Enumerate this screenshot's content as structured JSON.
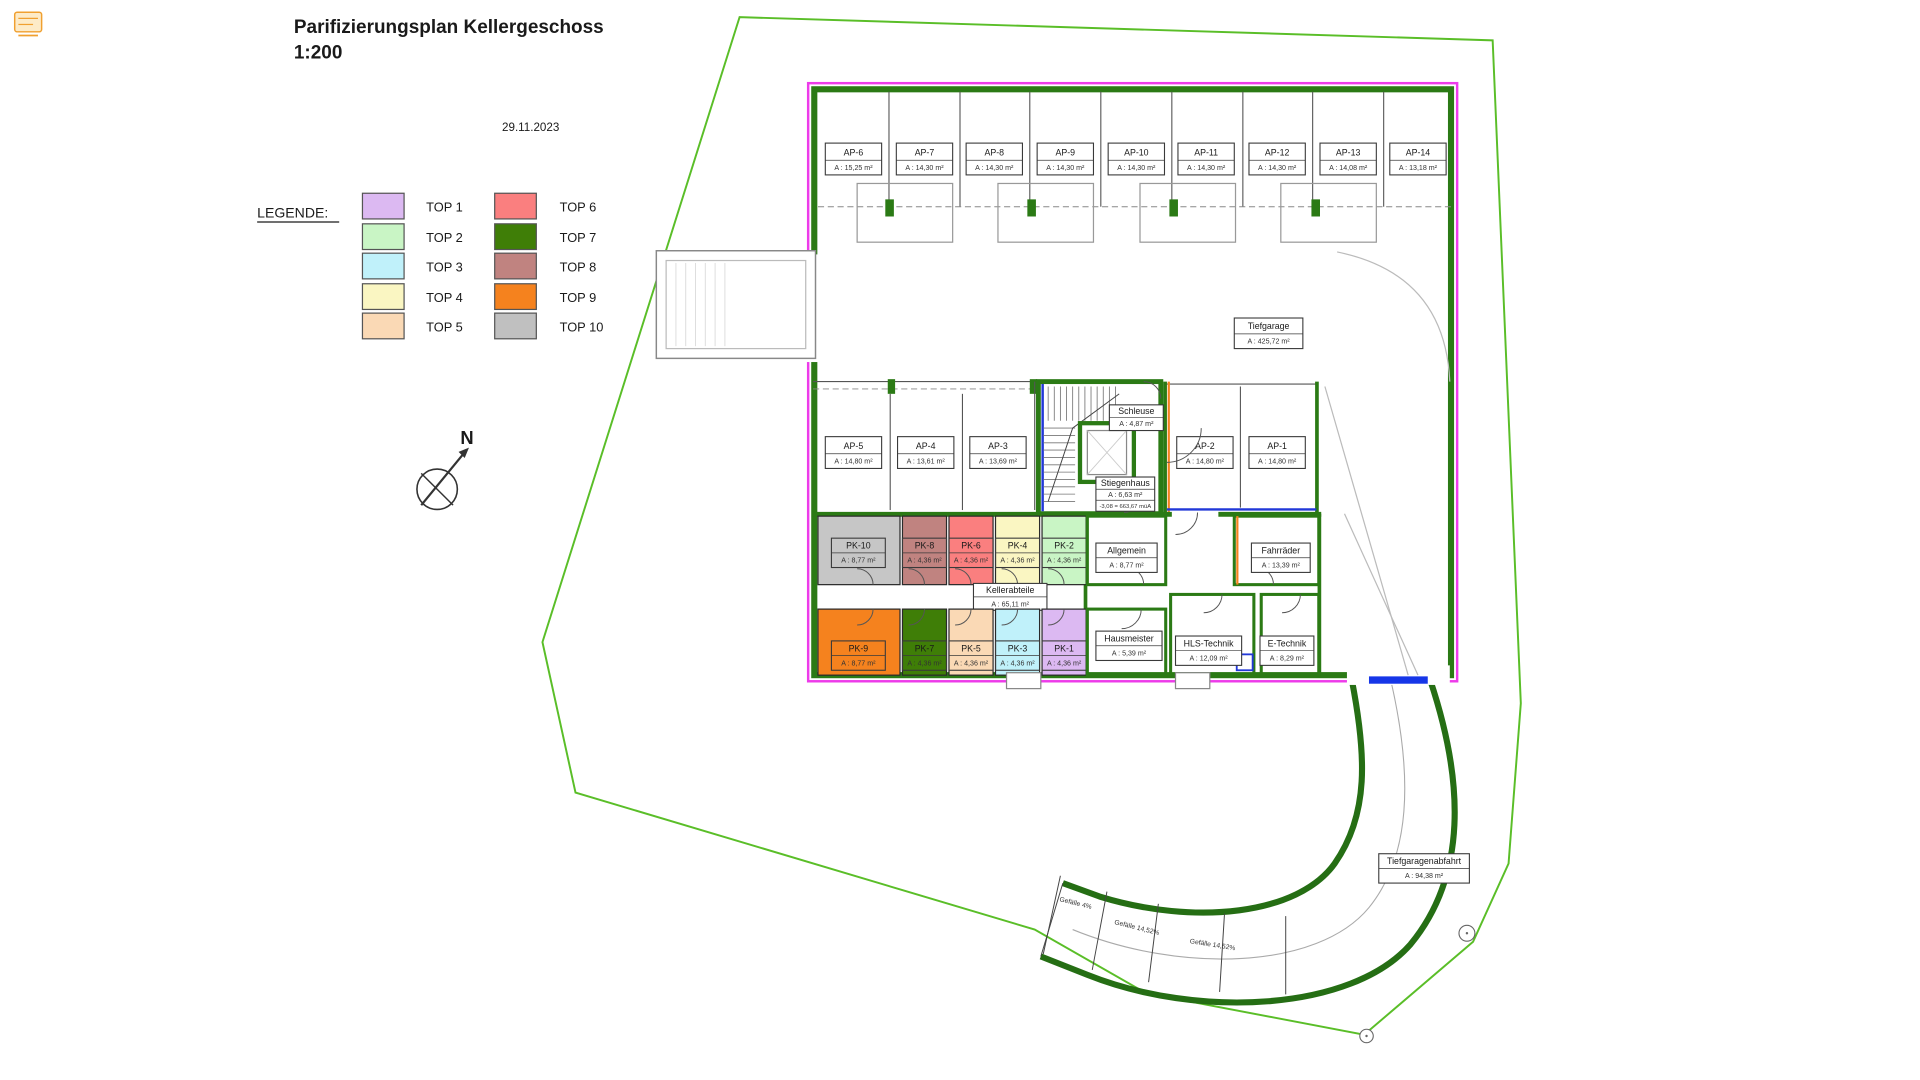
{
  "page": {
    "title_line1": "Parifizierungsplan Kellergeschoss",
    "title_line2": "1:200",
    "date": "29.11.2023",
    "north_label": "N"
  },
  "legend": {
    "title": "LEGENDE:",
    "items": [
      {
        "label": "TOP 1",
        "color": "#dcb9f2"
      },
      {
        "label": "TOP 2",
        "color": "#c9f5c5"
      },
      {
        "label": "TOP 3",
        "color": "#c0f1fa"
      },
      {
        "label": "TOP 4",
        "color": "#faf6c2"
      },
      {
        "label": "TOP 5",
        "color": "#fad9b5"
      },
      {
        "label": "TOP 6",
        "color": "#fa7f7f"
      },
      {
        "label": "TOP 7",
        "color": "#3f7e07"
      },
      {
        "label": "TOP 8",
        "color": "#c08380"
      },
      {
        "label": "TOP 9",
        "color": "#f5821e"
      },
      {
        "label": "TOP 10",
        "color": "#c0c0c0"
      }
    ]
  },
  "plan": {
    "wall_color": "#2b7a15",
    "boundary_color": "#5abe28",
    "outline_color": "#ed3bea",
    "parking_top": [
      {
        "id": "AP-6",
        "area": "A : 15,25 m²"
      },
      {
        "id": "AP-7",
        "area": "A : 14,30 m²"
      },
      {
        "id": "AP-8",
        "area": "A : 14,30 m²"
      },
      {
        "id": "AP-9",
        "area": "A : 14,30 m²"
      },
      {
        "id": "AP-10",
        "area": "A : 14,30 m²"
      },
      {
        "id": "AP-11",
        "area": "A : 14,30 m²"
      },
      {
        "id": "AP-12",
        "area": "A : 14,30 m²"
      },
      {
        "id": "AP-13",
        "area": "A : 14,08 m²"
      },
      {
        "id": "AP-14",
        "area": "A : 13,18 m²"
      }
    ],
    "parking_mid": [
      {
        "id": "AP-5",
        "area": "A : 14,80 m²"
      },
      {
        "id": "AP-4",
        "area": "A : 13,61 m²"
      },
      {
        "id": "AP-3",
        "area": "A : 13,69 m²"
      },
      {
        "id": "AP-2",
        "area": "A : 14,80 m²"
      },
      {
        "id": "AP-1",
        "area": "A : 14,80 m²"
      }
    ],
    "cellar_upper": [
      {
        "id": "PK-10",
        "area": "A : 8,77 m²",
        "color": "#c6c6c6"
      },
      {
        "id": "PK-8",
        "area": "A : 4,36 m²",
        "color": "#c08380"
      },
      {
        "id": "PK-6",
        "area": "A : 4,36 m²",
        "color": "#fa7f7f"
      },
      {
        "id": "PK-4",
        "area": "A : 4,36 m²",
        "color": "#faf6c2"
      },
      {
        "id": "PK-2",
        "area": "A : 4,36 m²",
        "color": "#c9f5c5"
      }
    ],
    "cellar_lower": [
      {
        "id": "PK-9",
        "area": "A : 8,77 m²",
        "color": "#f5821e"
      },
      {
        "id": "PK-7",
        "area": "A : 4,36 m²",
        "color": "#3f7e07"
      },
      {
        "id": "PK-5",
        "area": "A : 4,36 m²",
        "color": "#fad9b5"
      },
      {
        "id": "PK-3",
        "area": "A : 4,36 m²",
        "color": "#c0f1fa"
      },
      {
        "id": "PK-1",
        "area": "A : 4,36 m²",
        "color": "#dcb9f2"
      }
    ],
    "rooms": {
      "tiefgarage": {
        "name": "Tiefgarage",
        "area": "A : 425,72 m²"
      },
      "kellerabteile": {
        "name": "Kellerabteile",
        "area": "A : 65,11 m²"
      },
      "allgemein": {
        "name": "Allgemein",
        "area": "A : 8,77 m²"
      },
      "fahrraeder": {
        "name": "Fahrräder",
        "area": "A : 13,39 m²"
      },
      "hausmeister": {
        "name": "Hausmeister",
        "area": "A : 5,39 m²"
      },
      "hls": {
        "name": "HLS-Technik",
        "area": "A : 12,09 m²"
      },
      "etechnik": {
        "name": "E-Technik",
        "area": "A : 8,29 m²"
      },
      "schleuse": {
        "name": "Schleuse",
        "area": "A : 4,87 m²"
      },
      "stiegenhaus": {
        "name": "Stiegenhaus",
        "area": "A : 6,63 m²",
        "level": "-3,08 = 663,67 müA"
      },
      "abfahrt": {
        "name": "Tiefgaragenabfahrt",
        "area": "A : 94,38 m²"
      }
    },
    "slopes": [
      "Gefälle 4%",
      "Gefälle 14,52%",
      "Gefälle 14,52%"
    ]
  }
}
